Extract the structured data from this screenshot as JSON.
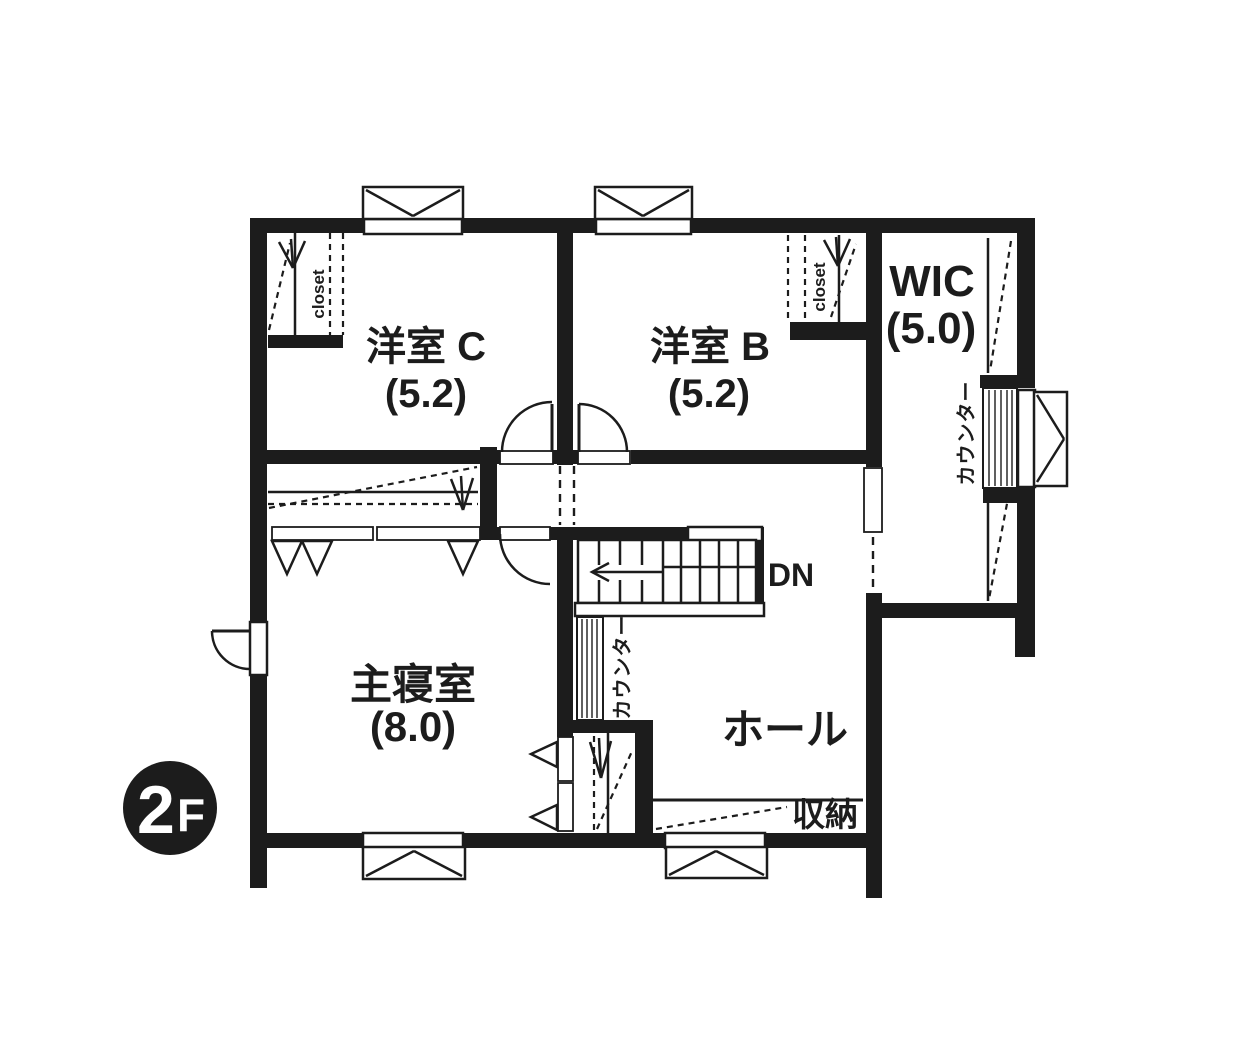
{
  "title": "2F floor plan",
  "floor_badge": {
    "number": "2",
    "suffix": "F"
  },
  "rooms": {
    "western_c": {
      "name": "洋室 C",
      "size": "(5.2)"
    },
    "western_b": {
      "name": "洋室 B",
      "size": "(5.2)"
    },
    "wic": {
      "name": "WIC",
      "size": "(5.0)"
    },
    "master_bedroom": {
      "name": "主寝室",
      "size": "(8.0)"
    },
    "hall": {
      "name": "ホール"
    }
  },
  "features": {
    "closet_c": "closet",
    "closet_b": "closet",
    "counter_hall": "カウンター",
    "counter_wic": "カウンター",
    "storage": "収納",
    "stairs_down": "DN"
  },
  "colors": {
    "wall": "#1c1c1c",
    "background": "#ffffff"
  }
}
